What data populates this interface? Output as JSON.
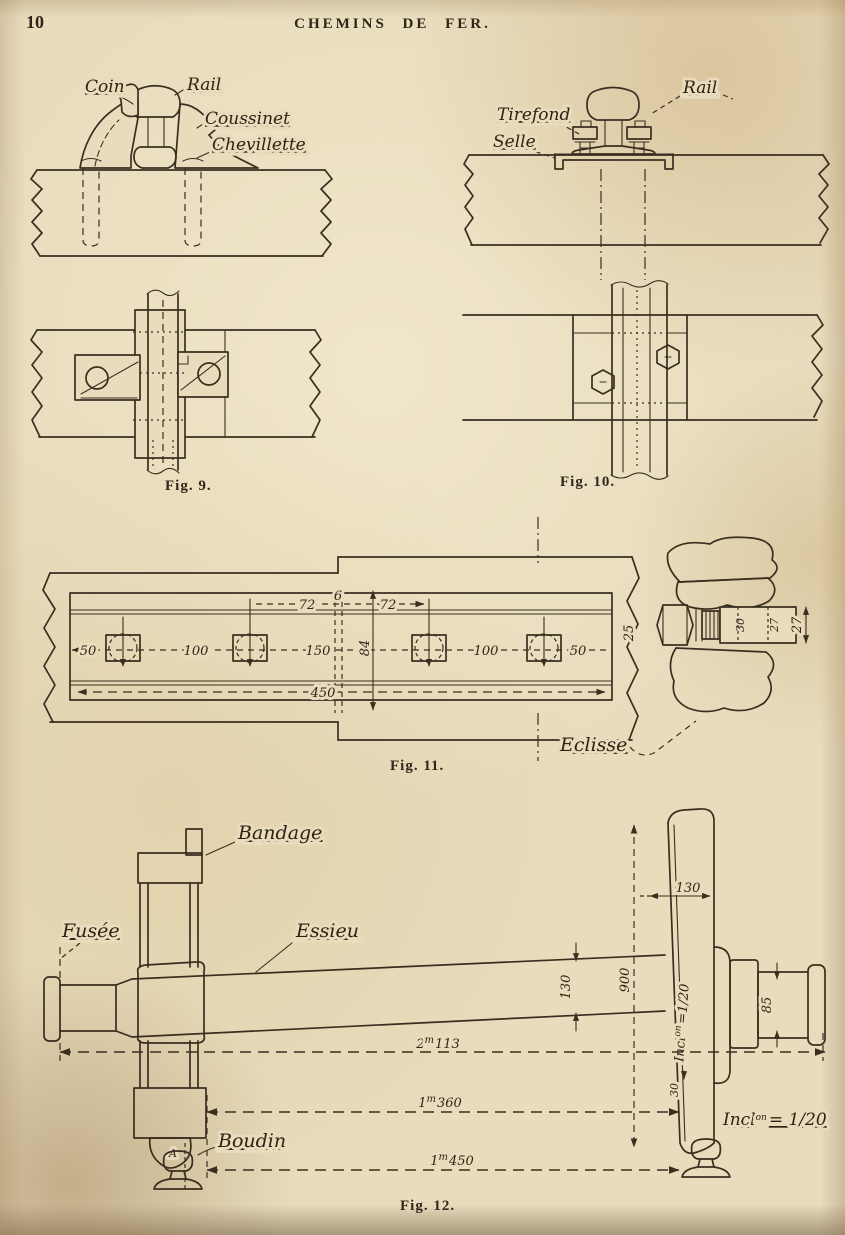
{
  "page": {
    "number": "10",
    "title": "CHEMINS DE FER."
  },
  "fig9": {
    "caption": "Fig. 9.",
    "coin": "Coin",
    "rail": "Rail",
    "coussinet": "Coussinet",
    "chevillette": "Chevillette"
  },
  "fig10": {
    "caption": "Fig. 10.",
    "tirefond": "Tirefond",
    "selle": "Selle",
    "rail": "Rail"
  },
  "fig11": {
    "caption": "Fig. 11.",
    "eclisse": "Eclisse",
    "d72a": "72",
    "d6": "6",
    "d72b": "72",
    "d50a": "50",
    "d100a": "100",
    "d150": "150",
    "d84": "84",
    "d100b": "100",
    "d50b": "50",
    "d450": "450",
    "d25": "25",
    "d30": "30",
    "d27a": "27",
    "d27b": "27"
  },
  "fig12": {
    "caption": "Fig. 12.",
    "bandage": "Bandage",
    "fusee": "Fusée",
    "essieu": "Essieu",
    "boudin": "Boudin",
    "point_a": "A",
    "rim": "130",
    "dia": "900",
    "axle": "130",
    "journal": "85",
    "flange": "30",
    "incl_word": "Incl",
    "incl_sup": "on",
    "incl_eq": "=1/20",
    "incl_eq2": "= 1/20",
    "len1_w": "2",
    "len1_sup": "m",
    "len1_f": "113",
    "len2_w": "1",
    "len2_sup": "m",
    "len2_f": "360",
    "len3_w": "1",
    "len3_sup": "m",
    "len3_f": "450"
  }
}
